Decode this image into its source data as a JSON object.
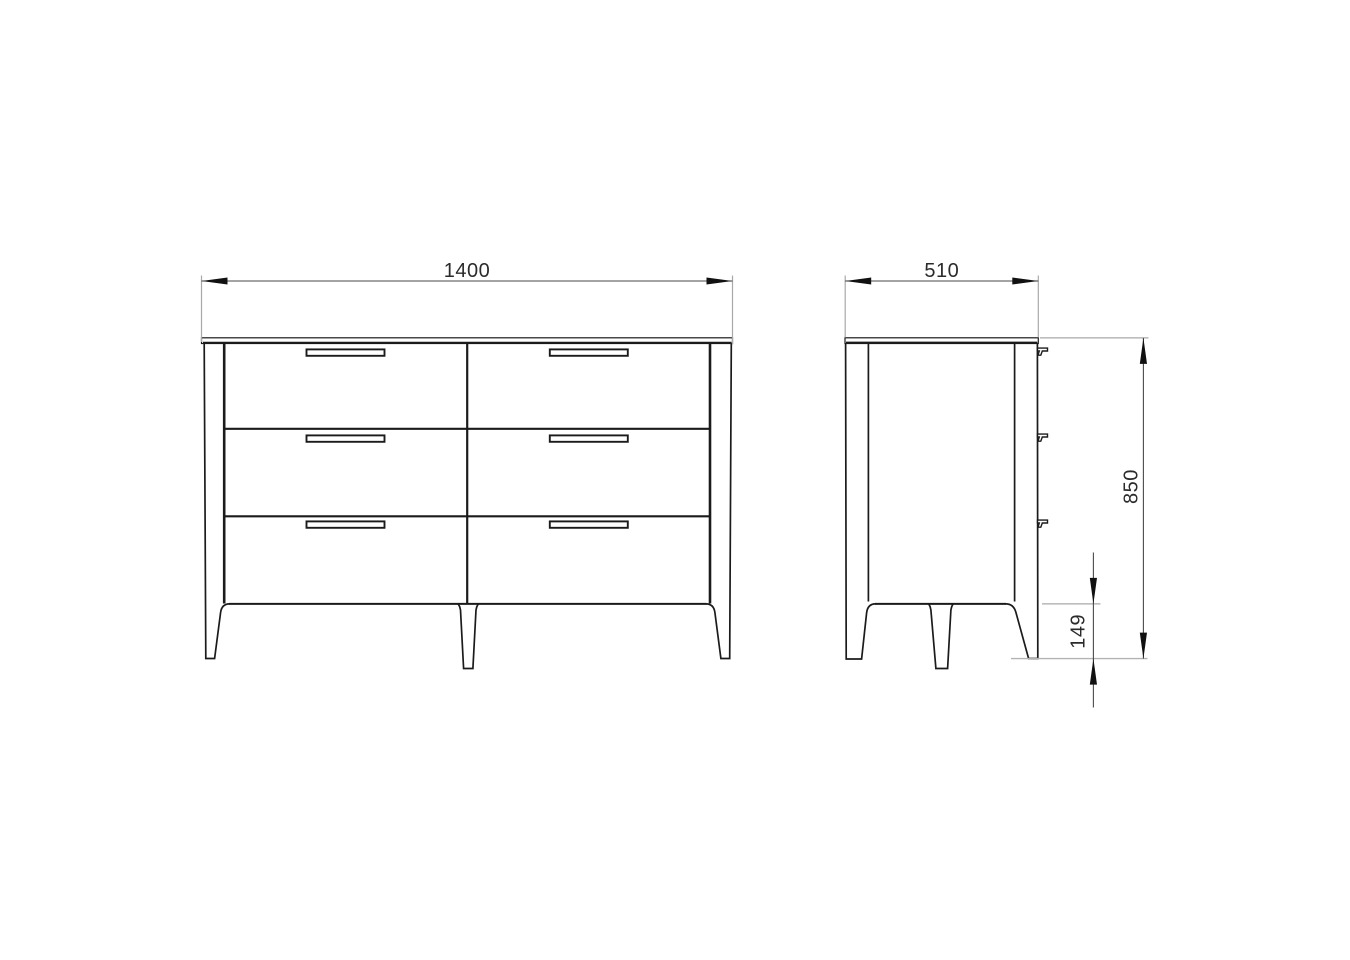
{
  "drawing": {
    "views": {
      "front": {
        "drawer_rows": 3,
        "drawer_columns": 2,
        "handle_count": 6,
        "leg_count": 3
      },
      "side": {
        "handle_count": 3,
        "leg_count": 3
      }
    },
    "dimensions": {
      "width": {
        "value": "1400",
        "orientation": "horizontal",
        "view": "front"
      },
      "depth": {
        "value": "510",
        "orientation": "horizontal",
        "view": "side"
      },
      "height": {
        "value": "850",
        "orientation": "vertical",
        "view": "side"
      },
      "leg_height": {
        "value": "149",
        "orientation": "vertical",
        "view": "side"
      }
    },
    "colors": {
      "outline": "#1b1b1b",
      "dimension_line": "#4a4a4a",
      "extension_line": "#a9a9a9",
      "arrow": "#111111",
      "text": "#2b2b2b",
      "background": "#ffffff"
    }
  }
}
